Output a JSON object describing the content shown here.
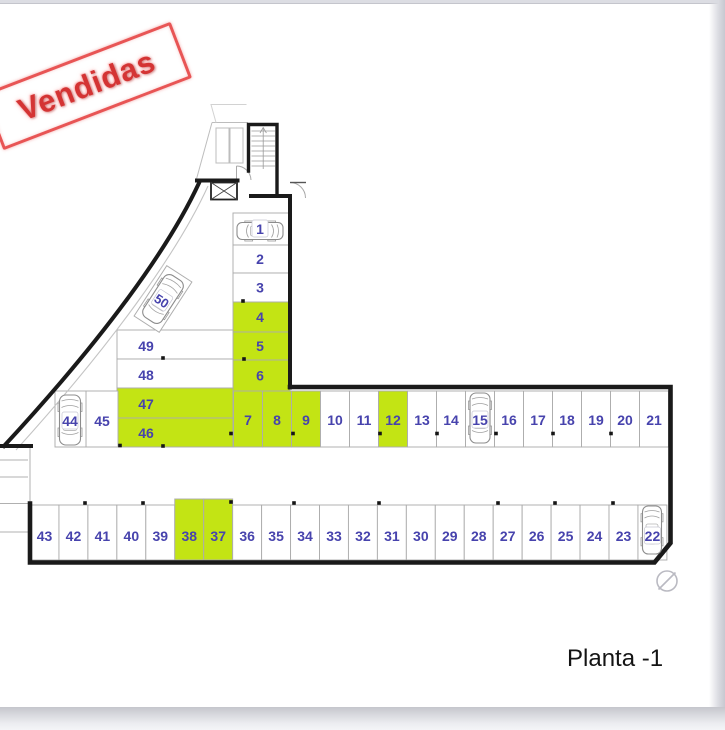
{
  "page": {
    "floor_label": "Planta -1"
  },
  "stamp": {
    "label": "Vendidas"
  },
  "colors": {
    "sold_fill": "#c3e414",
    "available_fill": "#ffffff",
    "number_color": "#4743ad",
    "wall_color": "#1a1a1a",
    "thin_line_color": "#adadad",
    "stamp_red": "#d43434"
  },
  "parking": {
    "column_spaces": [
      {
        "num": "1",
        "sold": false,
        "car": true
      },
      {
        "num": "2",
        "sold": false,
        "car": false
      },
      {
        "num": "3",
        "sold": false,
        "car": false
      },
      {
        "num": "4",
        "sold": true,
        "car": false
      },
      {
        "num": "5",
        "sold": true,
        "car": false
      },
      {
        "num": "6",
        "sold": true,
        "car": false
      }
    ],
    "top_row_spaces": [
      {
        "num": "7",
        "sold": true,
        "car": false
      },
      {
        "num": "8",
        "sold": true,
        "car": false
      },
      {
        "num": "9",
        "sold": true,
        "car": false
      },
      {
        "num": "10",
        "sold": false,
        "car": false
      },
      {
        "num": "11",
        "sold": false,
        "car": false
      },
      {
        "num": "12",
        "sold": true,
        "car": false
      },
      {
        "num": "13",
        "sold": false,
        "car": false
      },
      {
        "num": "14",
        "sold": false,
        "car": false
      },
      {
        "num": "15",
        "sold": false,
        "car": true
      },
      {
        "num": "16",
        "sold": false,
        "car": false
      },
      {
        "num": "17",
        "sold": false,
        "car": false
      },
      {
        "num": "18",
        "sold": false,
        "car": false
      },
      {
        "num": "19",
        "sold": false,
        "car": false
      },
      {
        "num": "20",
        "sold": false,
        "car": false
      },
      {
        "num": "21",
        "sold": false,
        "car": false
      }
    ],
    "bottom_row_spaces": [
      {
        "num": "43",
        "sold": false,
        "car": false
      },
      {
        "num": "42",
        "sold": false,
        "car": false
      },
      {
        "num": "41",
        "sold": false,
        "car": false
      },
      {
        "num": "40",
        "sold": false,
        "car": false
      },
      {
        "num": "39",
        "sold": false,
        "car": false
      },
      {
        "num": "38",
        "sold": true,
        "car": false
      },
      {
        "num": "37",
        "sold": true,
        "car": false
      },
      {
        "num": "36",
        "sold": false,
        "car": false
      },
      {
        "num": "35",
        "sold": false,
        "car": false
      },
      {
        "num": "34",
        "sold": false,
        "car": false
      },
      {
        "num": "33",
        "sold": false,
        "car": false
      },
      {
        "num": "32",
        "sold": false,
        "car": false
      },
      {
        "num": "31",
        "sold": false,
        "car": false
      },
      {
        "num": "30",
        "sold": false,
        "car": false
      },
      {
        "num": "29",
        "sold": false,
        "car": false
      },
      {
        "num": "28",
        "sold": false,
        "car": false
      },
      {
        "num": "27",
        "sold": false,
        "car": false
      },
      {
        "num": "26",
        "sold": false,
        "car": false
      },
      {
        "num": "25",
        "sold": false,
        "car": false
      },
      {
        "num": "24",
        "sold": false,
        "car": false
      },
      {
        "num": "23",
        "sold": false,
        "car": false
      },
      {
        "num": "22",
        "sold": false,
        "car": true
      }
    ],
    "left_cluster_spaces": [
      {
        "num": "49",
        "sold": false,
        "car": false
      },
      {
        "num": "48",
        "sold": false,
        "car": false
      },
      {
        "num": "47",
        "sold": true,
        "car": false
      },
      {
        "num": "46",
        "sold": true,
        "car": false
      },
      {
        "num": "45",
        "sold": false,
        "car": false
      },
      {
        "num": "44",
        "sold": false,
        "car": true
      }
    ],
    "angled_space": {
      "num": "50",
      "sold": false,
      "car": true
    }
  }
}
